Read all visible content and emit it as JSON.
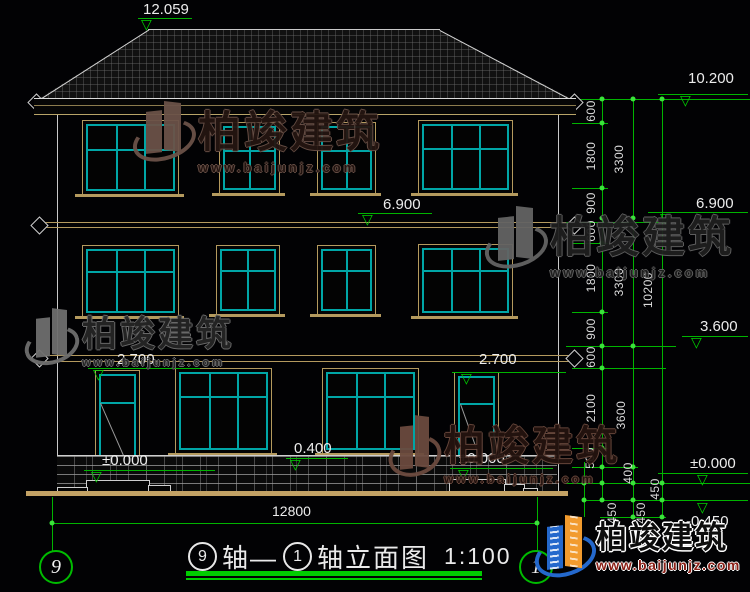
{
  "levels": {
    "roof_peak": "12.059",
    "eave": "10.200",
    "floor3_mid": "6.900",
    "floor3_right": "6.900",
    "belt": "3.600",
    "door_head_left": "2.700",
    "door_head_right": "2.700",
    "plinth_top": "0.400",
    "zero_left": "±0.000",
    "zero_mid": "±0.000",
    "zero_right": "±0.000",
    "minus": "-0.450"
  },
  "dims": {
    "chain1": [
      "600",
      "1800",
      "900",
      "600",
      "1800",
      "900",
      "600",
      "2100",
      "500"
    ],
    "chain2": [
      "3300",
      "3300",
      "3600",
      "400"
    ],
    "chain3": [
      "10200",
      "450",
      "450",
      "450"
    ],
    "total_width": "12800"
  },
  "axes": {
    "left": "9",
    "right": "1"
  },
  "title": {
    "bubble_left": "9",
    "seg_a": "轴—",
    "bubble_right": "1",
    "seg_b": "轴立面图",
    "scale": "1:100"
  },
  "watermark": {
    "brand": "柏竣建筑",
    "url": "www.baijunjz.com"
  },
  "logo": {
    "brand": "柏竣建筑",
    "url": "www.baijunjz.com"
  },
  "icons": {
    "elevation_triangle": "▽"
  },
  "colors": {
    "dimension_green": "#00b400",
    "frame_tan": "#b49a5e",
    "mullion_teal": "#00a6a6",
    "logo_blue": "#2468cc",
    "logo_orange": "#f29b2e"
  }
}
